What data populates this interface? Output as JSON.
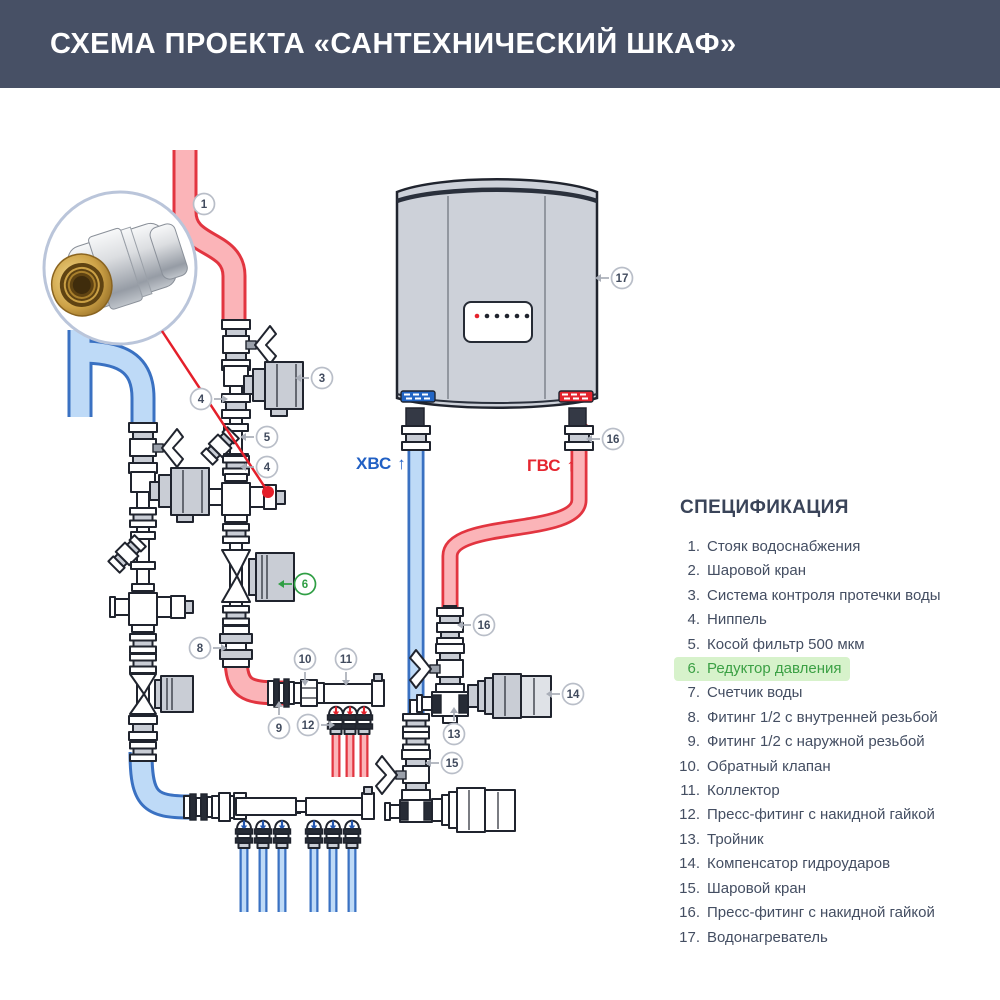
{
  "header": {
    "title": "СХЕМА ПРОЕКТА «САНТЕХНИЧЕСКИЙ ШКАФ»"
  },
  "diagram": {
    "labels": {
      "cold": {
        "text": "ХВС",
        "arrow": "↑"
      },
      "hot": {
        "text": "ГВС",
        "arrow": "↑"
      }
    },
    "callouts": [
      {
        "n": "1",
        "x": 204,
        "y": 204,
        "dir": "none"
      },
      {
        "n": "3",
        "x": 322,
        "y": 378,
        "dir": "left"
      },
      {
        "n": "4",
        "x": 201,
        "y": 399,
        "dir": "right"
      },
      {
        "n": "5",
        "x": 267,
        "y": 437,
        "dir": "left"
      },
      {
        "n": "4",
        "x": 267,
        "y": 467,
        "dir": "left"
      },
      {
        "n": "6",
        "x": 305,
        "y": 584,
        "dir": "left",
        "green": true
      },
      {
        "n": "8",
        "x": 200,
        "y": 648,
        "dir": "right"
      },
      {
        "n": "10",
        "x": 305,
        "y": 659,
        "dir": "down"
      },
      {
        "n": "11",
        "x": 346,
        "y": 659,
        "dir": "down"
      },
      {
        "n": "9",
        "x": 279,
        "y": 728,
        "dir": "up"
      },
      {
        "n": "12",
        "x": 308,
        "y": 725,
        "dir": "right"
      },
      {
        "n": "13",
        "x": 454,
        "y": 734,
        "dir": "up"
      },
      {
        "n": "14",
        "x": 573,
        "y": 694,
        "dir": "left"
      },
      {
        "n": "15",
        "x": 452,
        "y": 763,
        "dir": "left"
      },
      {
        "n": "16",
        "x": 613,
        "y": 439,
        "dir": "left"
      },
      {
        "n": "16",
        "x": 484,
        "y": 625,
        "dir": "left"
      },
      {
        "n": "17",
        "x": 622,
        "y": 278,
        "dir": "left"
      }
    ],
    "colors": {
      "hot_pipe": "#e23540",
      "cold_pipe": "#3a71c2",
      "accent_green": "#2f9e44",
      "header_bg": "#475065"
    }
  },
  "spec": {
    "heading": "СПЕЦИФИКАЦИЯ",
    "items": [
      {
        "num": "1.",
        "text": "Стояк водоснабжения",
        "highlight": false
      },
      {
        "num": "2.",
        "text": "Шаровой кран",
        "highlight": false
      },
      {
        "num": "3.",
        "text": "Система контроля протечки воды",
        "highlight": false
      },
      {
        "num": "4.",
        "text": "Ниппель",
        "highlight": false
      },
      {
        "num": "5.",
        "text": "Косой фильтр 500 мкм",
        "highlight": false
      },
      {
        "num": "6.",
        "text": "Редуктор давления",
        "highlight": true
      },
      {
        "num": "7.",
        "text": "Счетчик воды",
        "highlight": false
      },
      {
        "num": "8.",
        "text": "Фитинг 1/2 с внутренней резьбой",
        "highlight": false
      },
      {
        "num": "9.",
        "text": "Фитинг 1/2 с наружной резьбой",
        "highlight": false
      },
      {
        "num": "10.",
        "text": "Обратный клапан",
        "highlight": false
      },
      {
        "num": "11.",
        "text": "Коллектор",
        "highlight": false
      },
      {
        "num": "12.",
        "text": "Пресс-фитинг с накидной гайкой",
        "highlight": false
      },
      {
        "num": "13.",
        "text": "Тройник",
        "highlight": false
      },
      {
        "num": "14.",
        "text": "Компенсатор гидроударов",
        "highlight": false
      },
      {
        "num": "15.",
        "text": "Шаровой кран",
        "highlight": false
      },
      {
        "num": "16.",
        "text": "Пресс-фитинг с накидной гайкой",
        "highlight": false
      },
      {
        "num": "17.",
        "text": "Водонагреватель",
        "highlight": false
      }
    ]
  }
}
